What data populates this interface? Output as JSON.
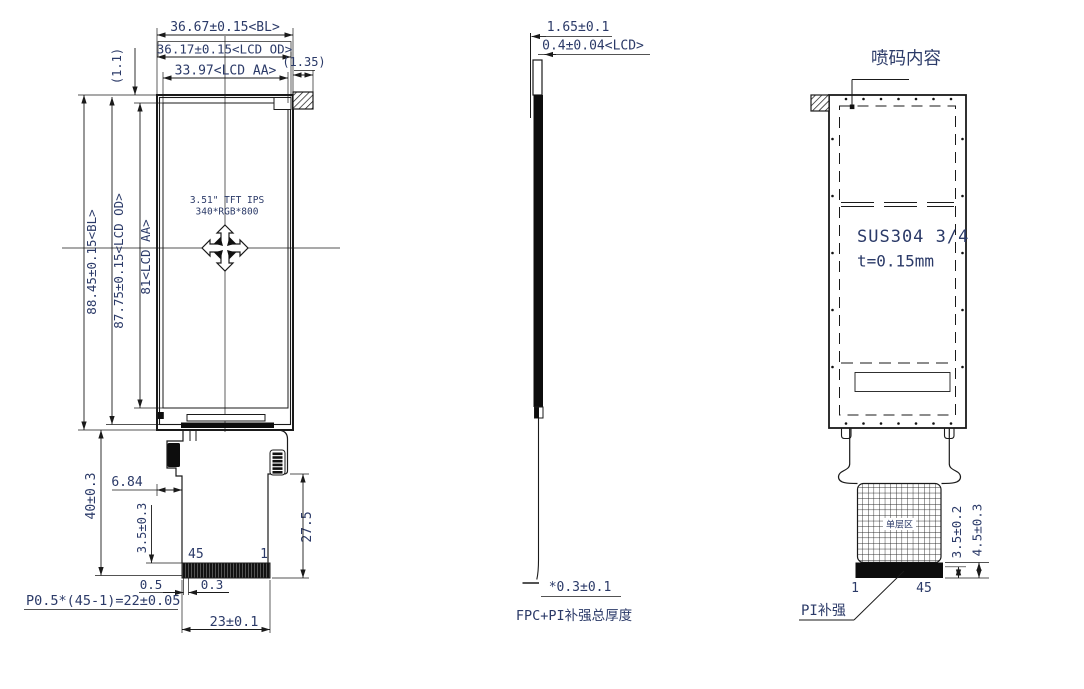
{
  "colors": {
    "line": "#1a1a1a",
    "dim_text": "#2b3a68",
    "black_fill": "#0d0d0d",
    "bg": "#ffffff"
  },
  "front_view": {
    "dim_width_bl": "36.67±0.15<BL>",
    "dim_width_lcd_od": "36.17±0.15<LCD OD>",
    "dim_width_lcd_aa": "33.97<LCD AA>",
    "dim_tab_width": "(1.35)",
    "dim_top_offset": "(1.1)",
    "dim_height_bl": "88.45±0.15<BL>",
    "dim_height_lcd_od": "87.75±0.15<LCD OD>",
    "dim_height_lcd_aa": "81<LCD AA>",
    "panel_line1": "3.51\" TFT IPS",
    "panel_line2": "340*RGB*800",
    "dim_tail_length": "40±0.3",
    "dim_notch": "6.84",
    "dim_stiffener": "3.5±0.3",
    "dim_tail_lower": "27.5",
    "pin_label_left": "45",
    "pin_label_right": "1",
    "dim_pin_a": "0.5",
    "dim_pin_b": "0.3",
    "dim_pitch": "P0.5*(45-1)=22±0.05",
    "dim_connector_width": "23±0.1"
  },
  "side_view": {
    "dim_total_thickness": "1.65±0.1",
    "dim_lcd_thickness": "0.4±0.04<LCD>",
    "dim_fpc_thickness": "*0.3±0.1",
    "caption": "FPC+PI补强总厚度"
  },
  "back_view": {
    "title": "喷码内容",
    "material_line1": "SUS304  3/4",
    "material_line2": "t=0.15mm",
    "single_layer_label": "单层区",
    "dim_pad_inner": "3.5±0.2",
    "dim_pad_outer": "4.5±0.3",
    "pin_label_left": "1",
    "pin_label_right": "45",
    "stiffener_label": "PI补强"
  }
}
